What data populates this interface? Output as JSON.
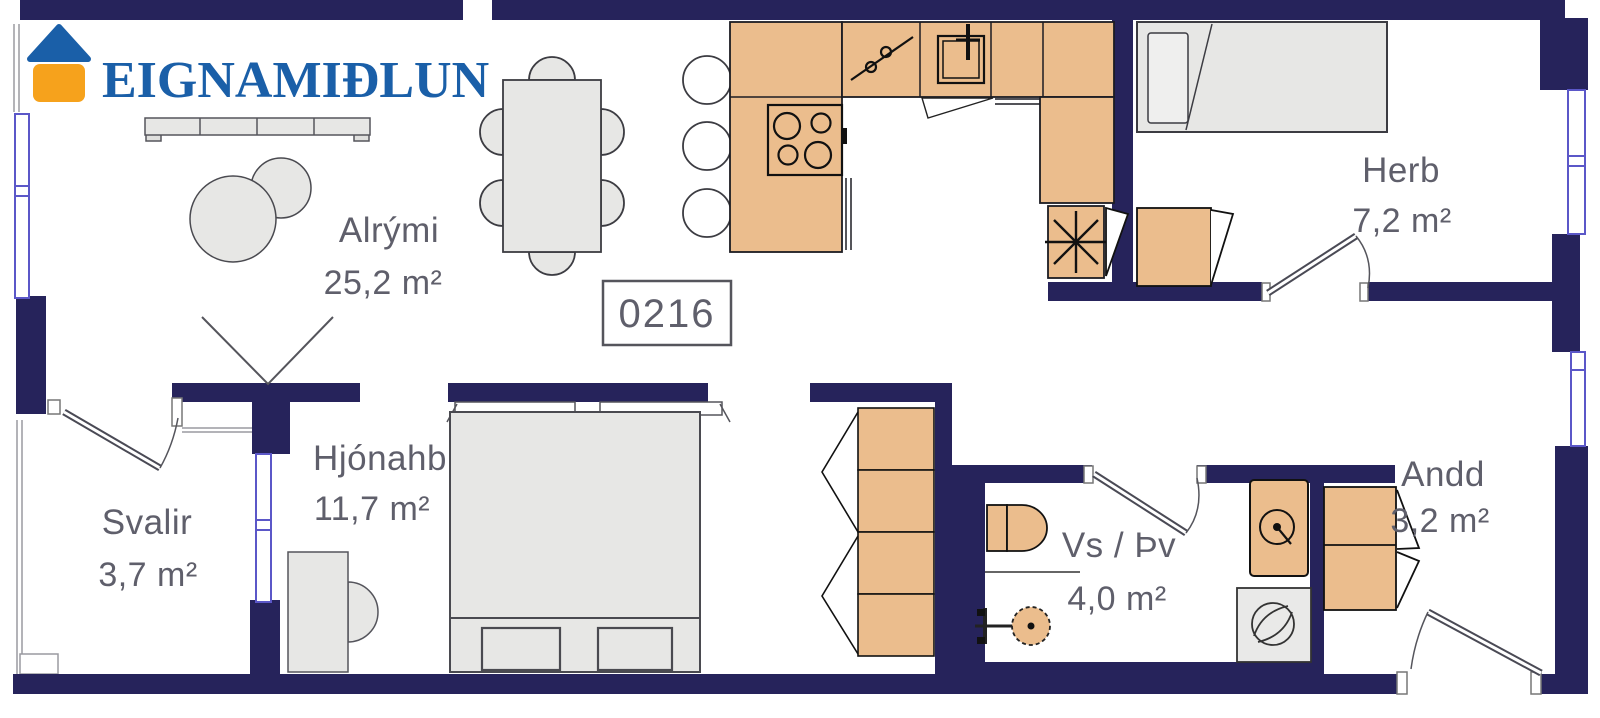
{
  "brand": {
    "name": "EIGNAMIÐLUN"
  },
  "unit": {
    "number": "0216"
  },
  "rooms": [
    {
      "id": "alrymi",
      "name": "Alrými",
      "area": "25,2 m²"
    },
    {
      "id": "hjonahb",
      "name": "Hjónahb",
      "area": "11,7 m²"
    },
    {
      "id": "svalir",
      "name": "Svalir",
      "area": "3,7 m²"
    },
    {
      "id": "herb",
      "name": "Herb",
      "area": "7,2 m²"
    },
    {
      "id": "vs_thv",
      "name": "Vs / Þv",
      "area": "4,0 m²"
    },
    {
      "id": "andd",
      "name": "Andd",
      "area": "3,2 m²"
    }
  ],
  "palette": {
    "wall": "#26235B",
    "counter": "#EBBD8D",
    "furniture": "#E7E7E5",
    "outline": "#4A4A55",
    "label": "#5F5F6B",
    "window": "#5B57C8",
    "logo-blue": "#1A5FA8",
    "logo-orange": "#F6A21C",
    "background": "#FFFFFF"
  }
}
